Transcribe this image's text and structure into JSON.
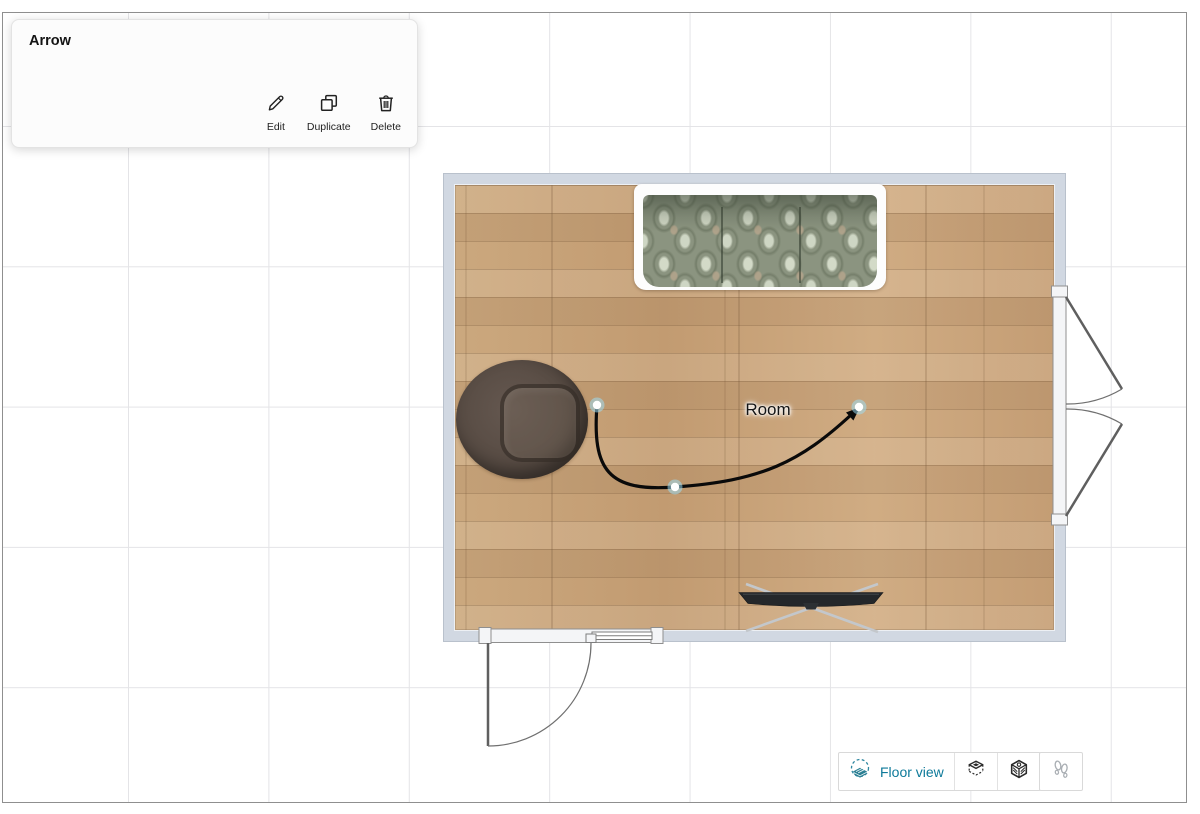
{
  "panel": {
    "title": "Arrow",
    "actions": [
      {
        "id": "edit",
        "label": "Edit",
        "icon": "pencil-icon"
      },
      {
        "id": "duplicate",
        "label": "Duplicate",
        "icon": "duplicate-icon"
      },
      {
        "id": "delete",
        "label": "Delete",
        "icon": "trash-icon"
      }
    ]
  },
  "annotation": {
    "type": "arrow",
    "label": "Room",
    "handle_count": 3
  },
  "viewbar": {
    "floor_view_label": "Floor view",
    "buttons": [
      "floor-view",
      "3d-box-view",
      "3d-orbit-view",
      "walk-mode"
    ]
  },
  "room_objects": [
    "sofa",
    "armchair",
    "tv-stand",
    "door-bottom",
    "double-door-right"
  ],
  "colors": {
    "accent_teal": "#0e7a9a",
    "wall": "#d1d8e2",
    "floor_wood": "#c8a478",
    "arrow": "#0a0a0a",
    "grid_line": "#e4e4e7",
    "canvas_border": "#8f8f8f",
    "handle_halo": "#9fdcf2"
  }
}
